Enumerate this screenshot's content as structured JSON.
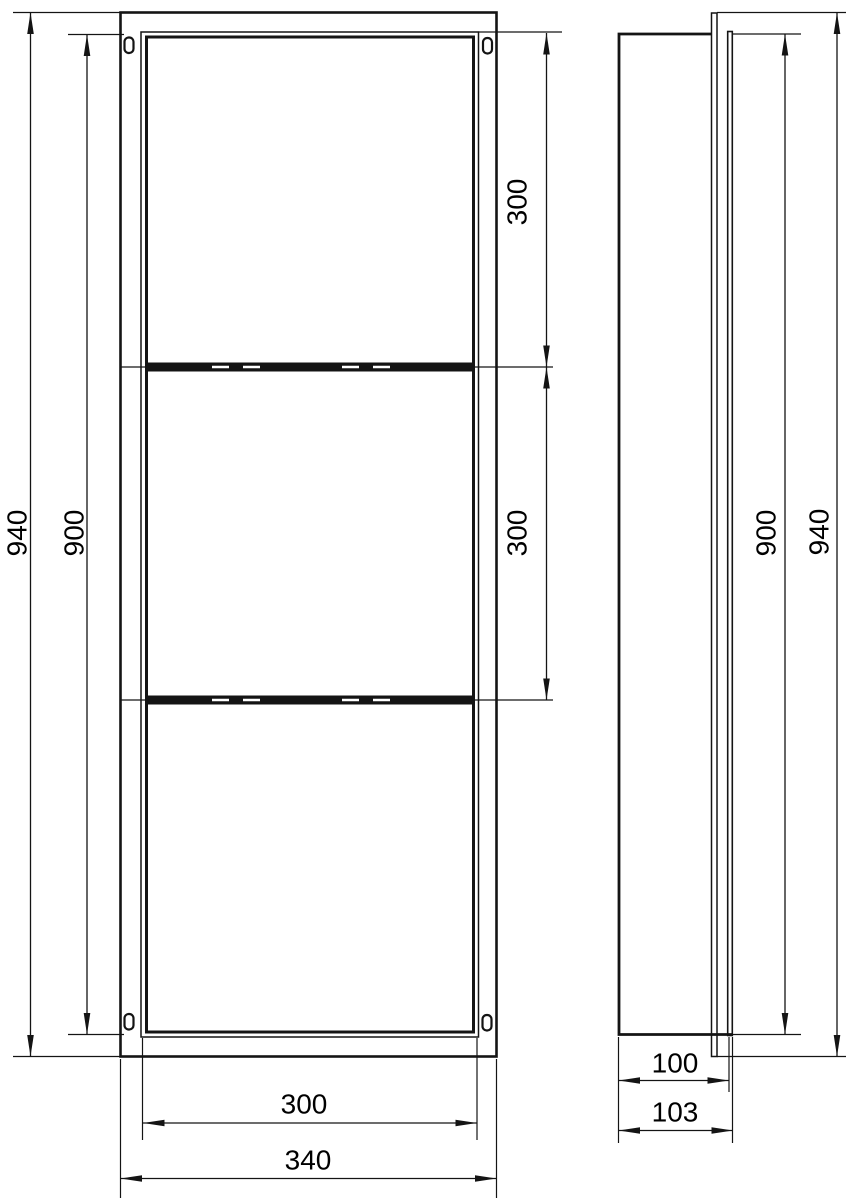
{
  "document": {
    "type": "technical dimension drawing",
    "subject": "recessed wall niche with two shelves, front view and side view"
  },
  "front_view": {
    "dims": {
      "overall_height": "940",
      "opening_height": "900",
      "top_compartment_height": "300",
      "middle_compartment_height": "300",
      "opening_width": "300",
      "overall_width": "340"
    }
  },
  "side_view": {
    "dims": {
      "opening_height": "900",
      "overall_height": "940",
      "recess_depth": "100",
      "overall_depth": "103"
    }
  },
  "colors": {
    "line": "#141414",
    "text": "#000000",
    "background": "#ffffff"
  }
}
